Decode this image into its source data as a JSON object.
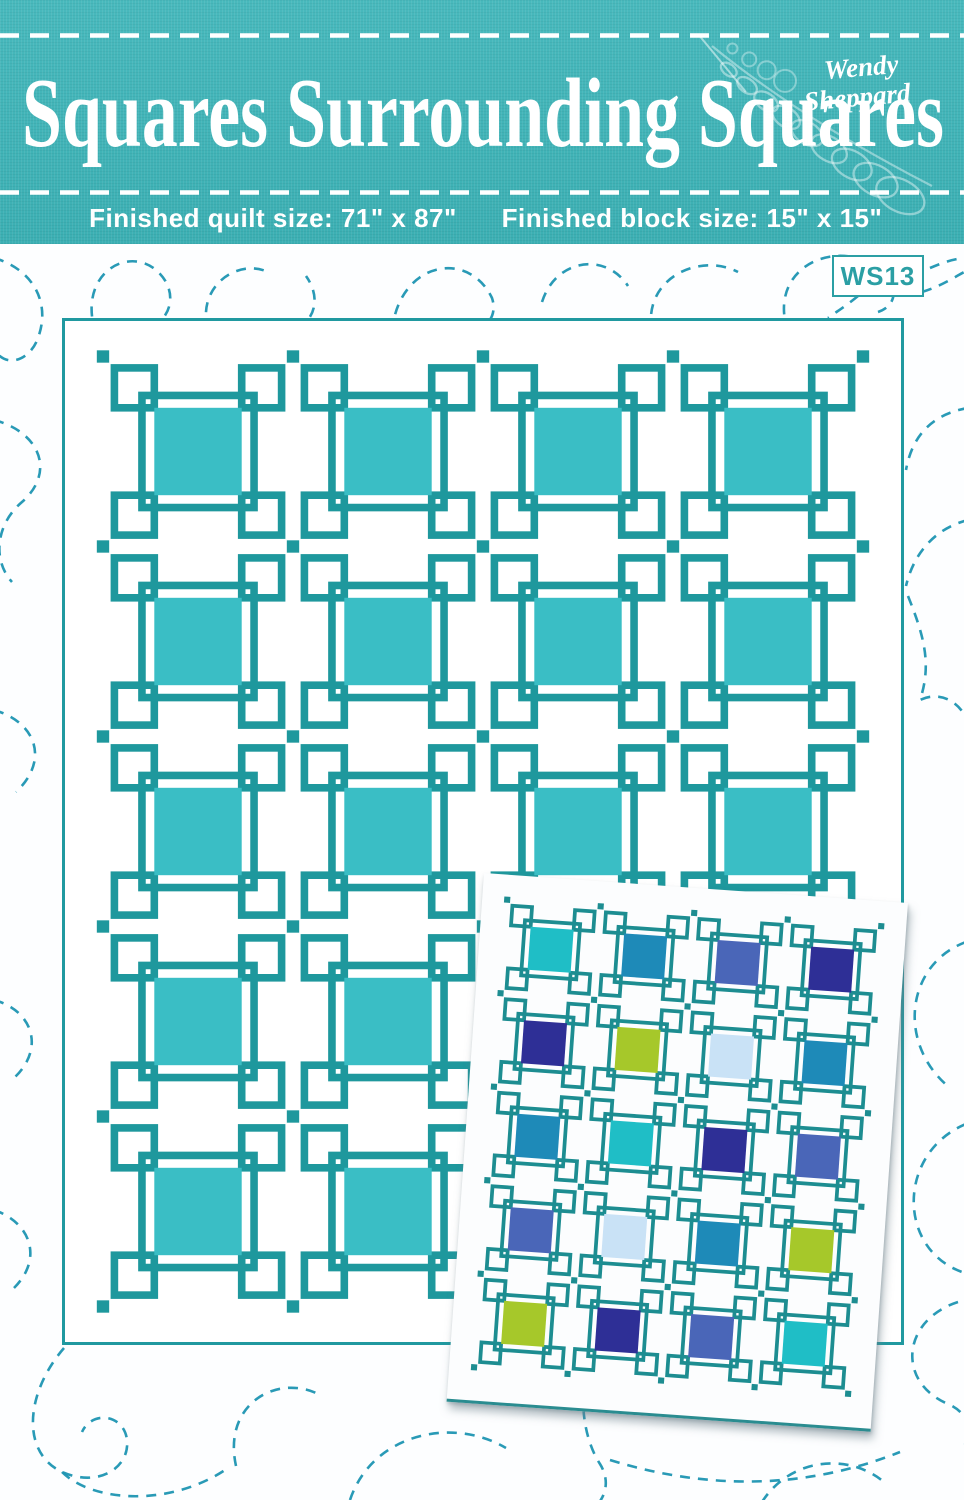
{
  "header": {
    "title": "Squares Surrounding Squares",
    "logo": {
      "line1": "Wendy",
      "line2": "Sheppard"
    },
    "quilt_size_label": "Finished quilt size: 71\" x 87\"",
    "block_size_label": "Finished block size: 15\" x 15\""
  },
  "badge": {
    "label": "WS13"
  },
  "colors": {
    "page_bg": "#fdfeff",
    "band": "#3eb5b9",
    "band_text": "#ffffff",
    "stitch_white": "#ffffff",
    "swirl": "#1d95b2",
    "badge": "#2b9fa4",
    "panel_border": "#2099a0",
    "card_bg": "#fcfdfe",
    "card_edge": "#2a8c90"
  },
  "main_quilt": {
    "cols": 4,
    "rows": 5,
    "frame_color": "#1e989d",
    "center_color": "#3abec5",
    "gap_color": "#ffffff"
  },
  "inset_quilt": {
    "cols": 4,
    "rows": 5,
    "frame_color": "#1d8d91",
    "gap_color": "#ffffff",
    "rotation_deg": 4,
    "palette": {
      "turquoise": "#1fbec6",
      "ocean": "#1e8ab8",
      "royal": "#4a66b8",
      "navy": "#2e2f96",
      "lime": "#a6c82a",
      "pale": "#c9e2f6"
    },
    "cell_colors": [
      [
        "turquoise",
        "ocean",
        "royal",
        "navy"
      ],
      [
        "navy",
        "lime",
        "pale",
        "ocean"
      ],
      [
        "ocean",
        "turquoise",
        "navy",
        "royal"
      ],
      [
        "royal",
        "pale",
        "ocean",
        "lime"
      ],
      [
        "lime",
        "navy",
        "royal",
        "turquoise"
      ]
    ]
  }
}
